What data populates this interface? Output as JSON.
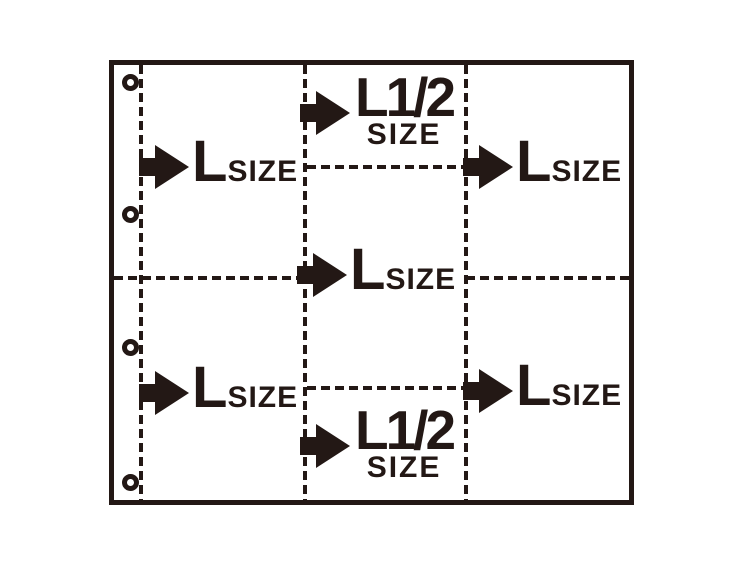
{
  "colors": {
    "ink": "#231815",
    "background": "#ffffff"
  },
  "icons": {
    "arrow": "right-arrow",
    "hole": "binder-hole"
  },
  "labels": {
    "top_left": {
      "main": "L",
      "sub": "SIZE"
    },
    "top_middle": {
      "main": "L1/2",
      "sub": "SIZE"
    },
    "top_right": {
      "main": "L",
      "sub": "SIZE"
    },
    "center": {
      "main": "L",
      "sub": "SIZE"
    },
    "bottom_left": {
      "main": "L",
      "sub": "SIZE"
    },
    "bottom_middle": {
      "main": "L1/2",
      "sub": "SIZE"
    },
    "bottom_right": {
      "main": "L",
      "sub": "SIZE"
    }
  }
}
